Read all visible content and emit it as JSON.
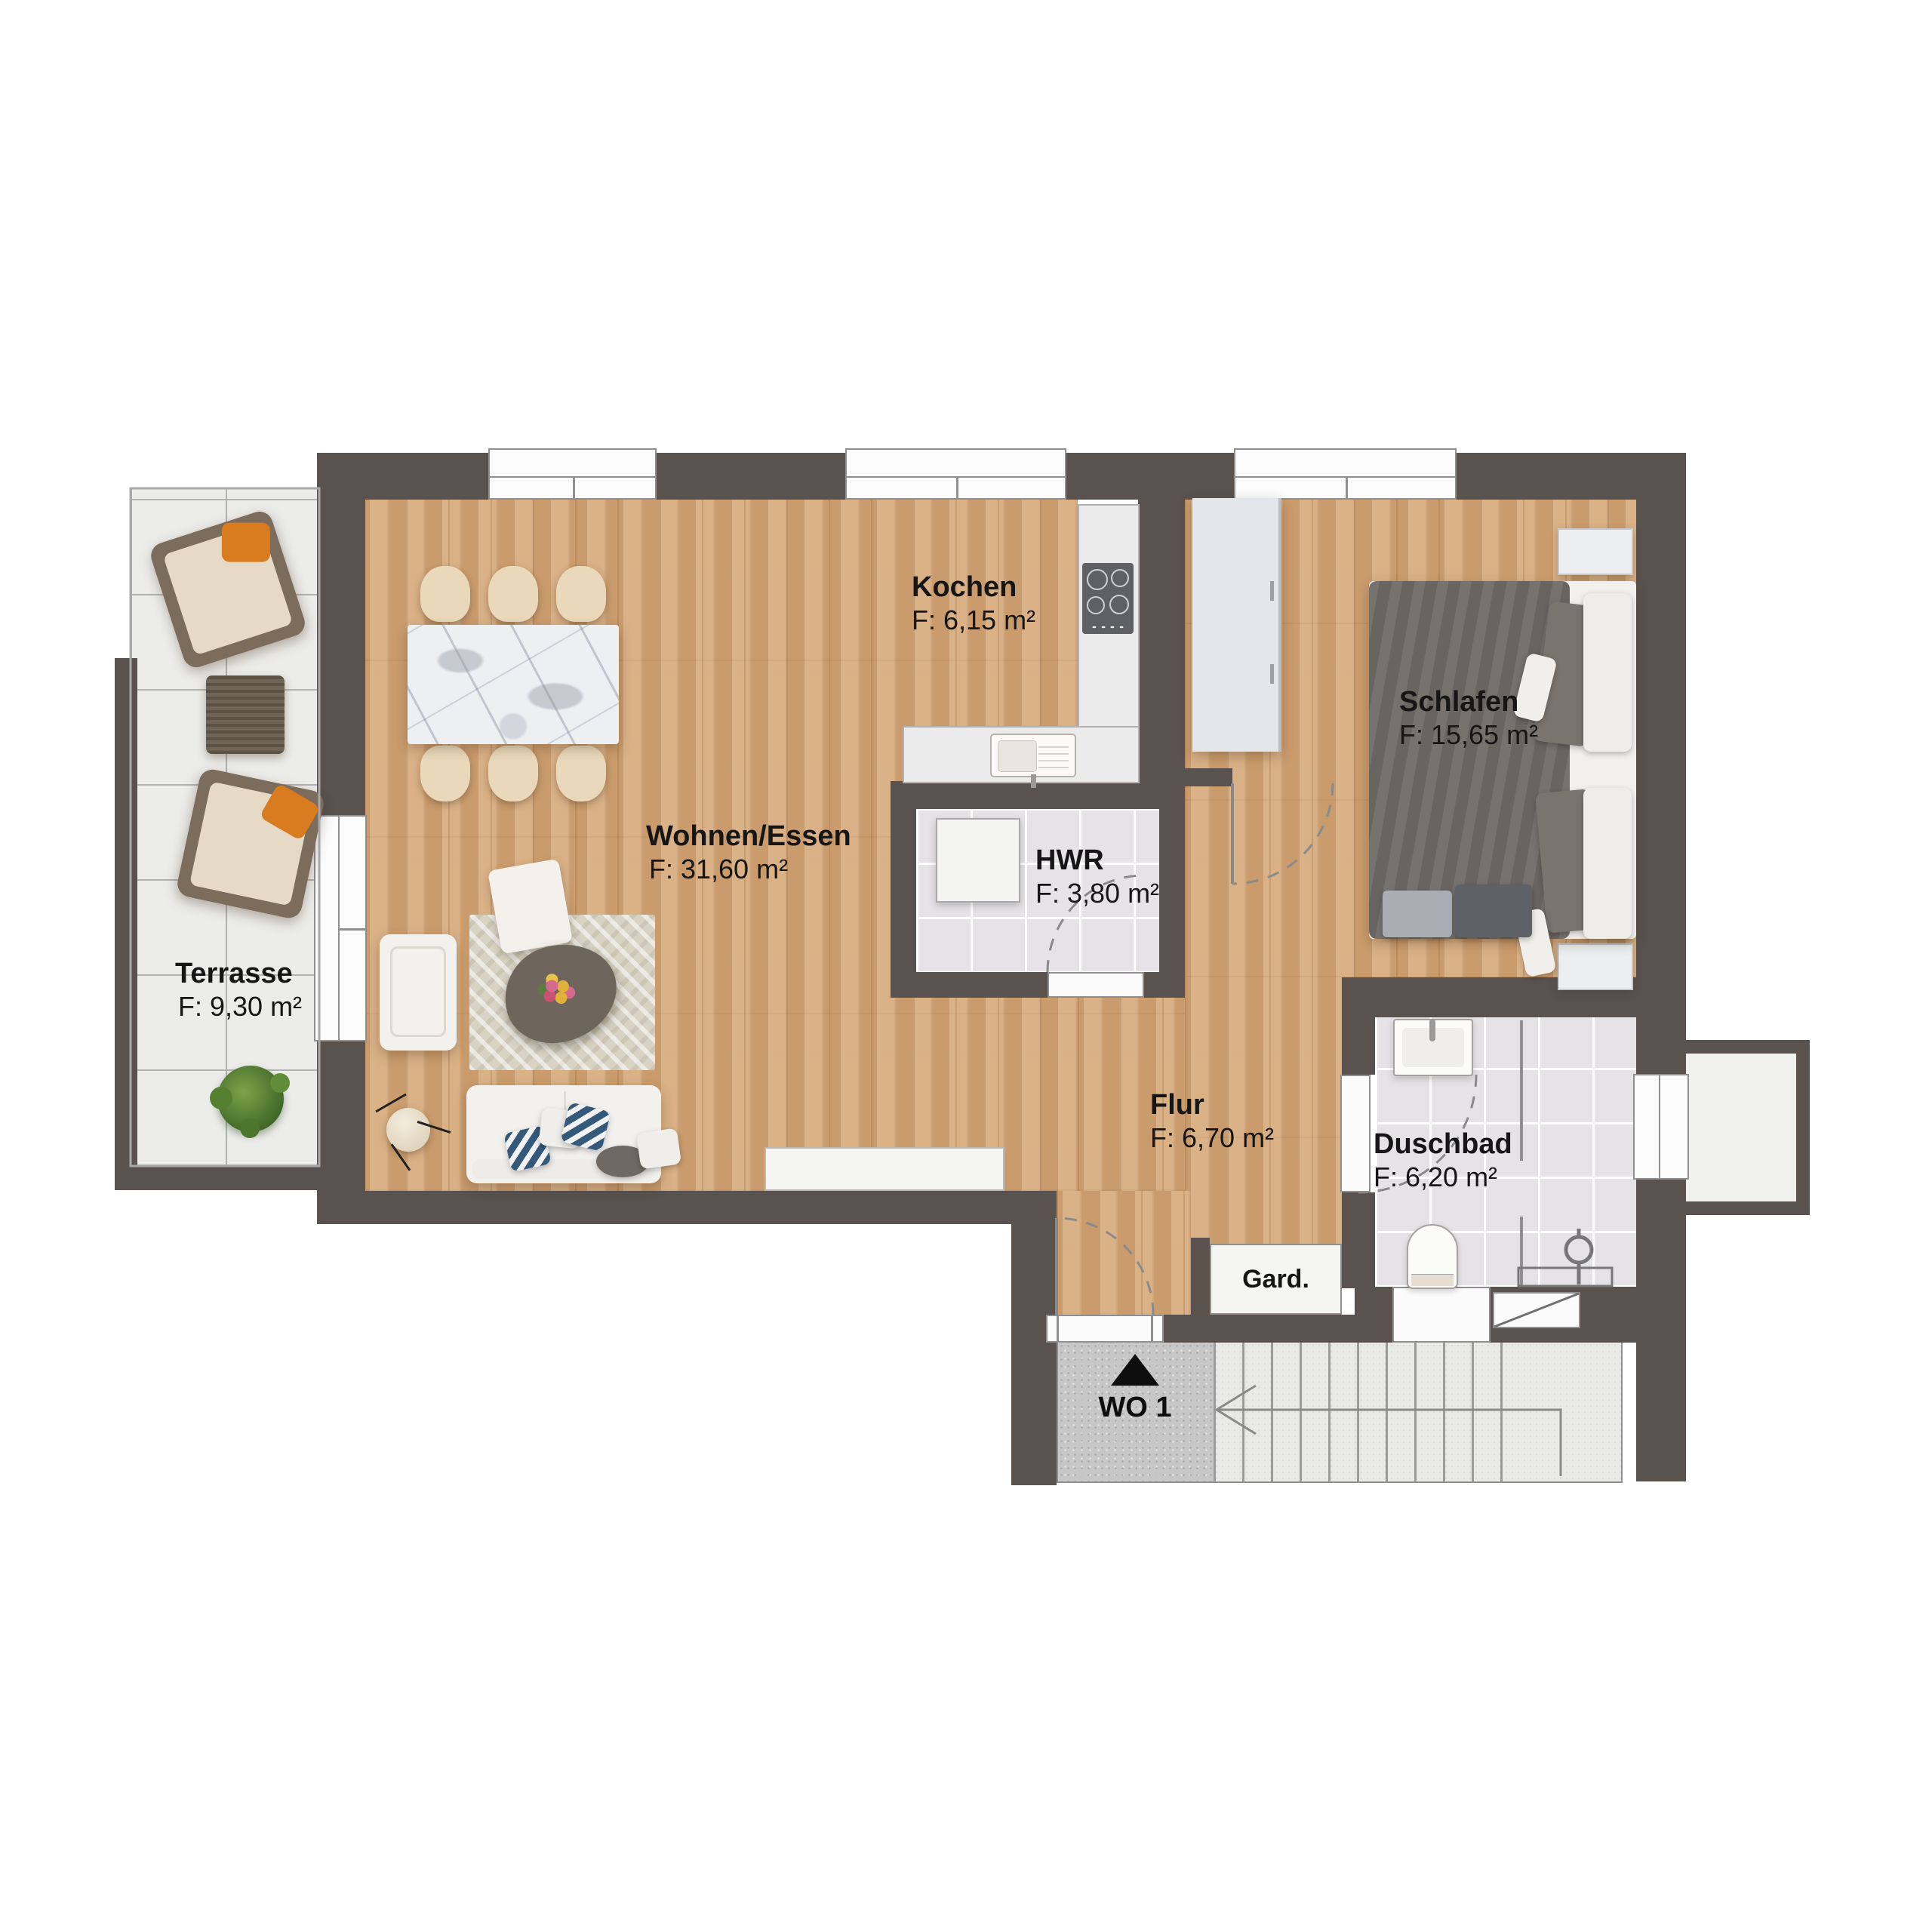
{
  "unit": {
    "label": "WO 1"
  },
  "rooms": {
    "terrace": {
      "name": "Terrasse",
      "area": "F: 9,30 m²"
    },
    "living": {
      "name": "Wohnen/Essen",
      "area": "F: 31,60 m²"
    },
    "kitchen": {
      "name": "Kochen",
      "area": "F: 6,15 m²"
    },
    "utility": {
      "name": "HWR",
      "area": "F: 3,80 m²"
    },
    "bedroom": {
      "name": "Schlafen",
      "area": "F: 15,65 m²"
    },
    "hall": {
      "name": "Flur",
      "area": "F: 6,70 m²"
    },
    "bathroom": {
      "name": "Duschbad",
      "area": "F: 6,20 m²"
    },
    "wardrobe": {
      "name": "Gard."
    }
  },
  "colors": {
    "wall": "#59524e",
    "wood_floor": "#d1a375",
    "bath_tile": "#e5e3e6",
    "terrace_tile": "#ececea",
    "concrete": "#c7c7c7",
    "accent_orange": "#d97b1f",
    "bed_gray": "#6f6a66",
    "pillow_blue": "#35597a"
  }
}
